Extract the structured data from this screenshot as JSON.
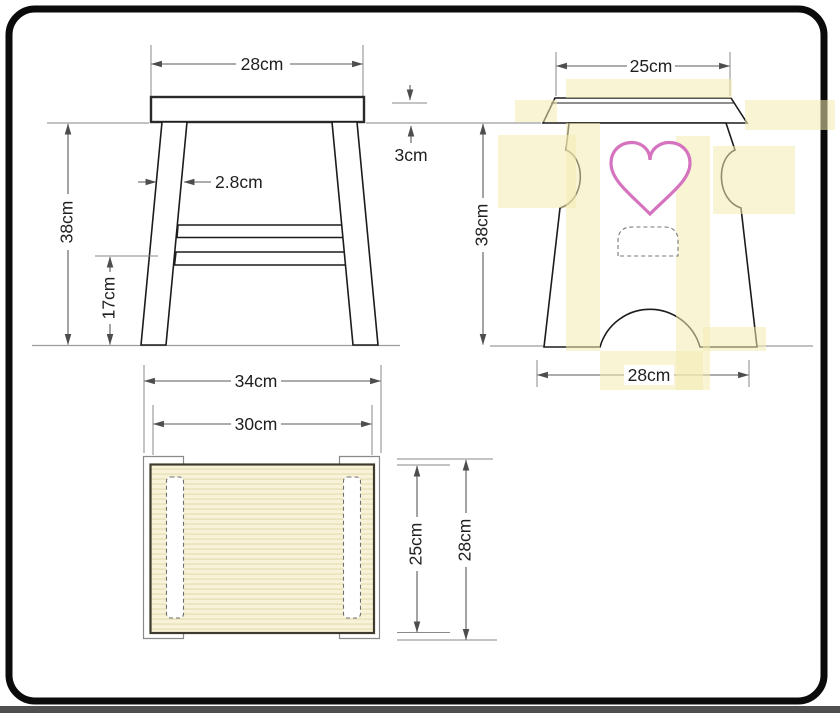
{
  "drawing": {
    "type": "furniture working drawing - wooden stool, three orthographic views",
    "views": {
      "side": {
        "label": "side view",
        "top_width": "28cm",
        "leg_thickness": "2.8cm",
        "height": "38cm",
        "stretcher_height": "17cm"
      },
      "front": {
        "label": "front view",
        "top_width": "25cm",
        "seat_thickness": "3cm",
        "height": "38cm",
        "bottom_width": "28cm"
      },
      "plan": {
        "label": "top view",
        "overall_width": "34cm",
        "top_width": "30cm",
        "top_depth": "25cm",
        "overall_depth": "28cm"
      }
    },
    "colors": {
      "outline": "#1c1c1c",
      "dimension": "#5a5a5a",
      "heart": "#d673bf",
      "highlight": "#f2ebb0",
      "wood": "#f8f3d8",
      "wood_stripe": "#ebe4bf",
      "frame": "#0b0b0b"
    }
  }
}
